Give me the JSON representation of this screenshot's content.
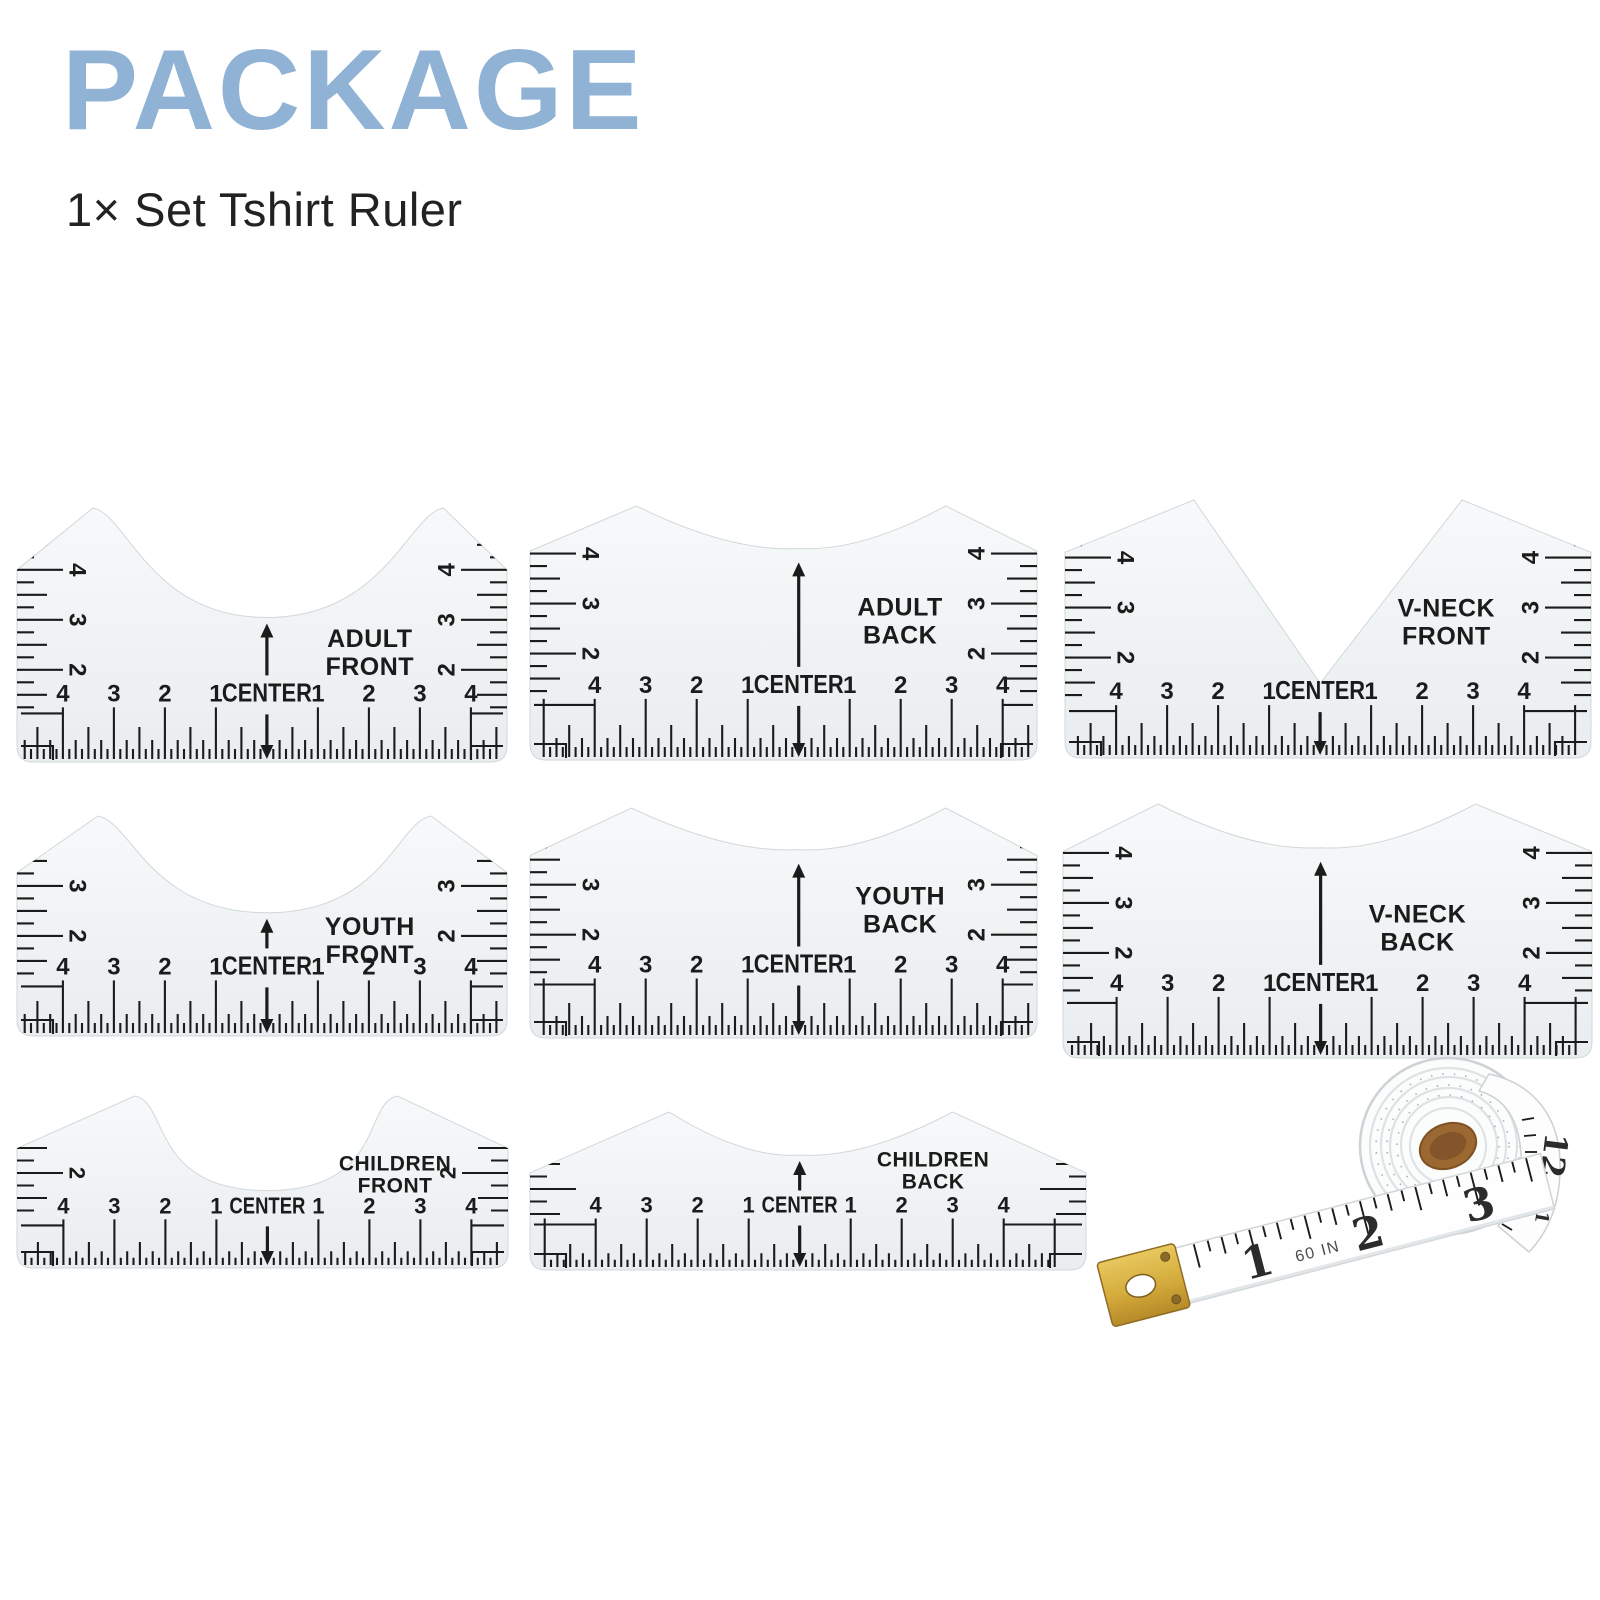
{
  "header": {
    "title": "PACKAGE",
    "subtitle": "1× Set Tshirt Ruler",
    "title_color": "#8fb2d5",
    "subtitle_color": "#222222"
  },
  "colors": {
    "ruler_ink": "#1b1b1b",
    "ruler_body_light": "#f7f9fa",
    "ruler_body_dark": "#e9edef",
    "tape_gold": "#d4ab3c",
    "tape_core_brown": "#9c6832"
  },
  "rulers": [
    {
      "id": "adult-front",
      "label": [
        "ADULT",
        "FRONT"
      ],
      "center_label": "CENTER",
      "side_numbers": [
        "4",
        "3",
        "2"
      ],
      "bottom_numbers": [
        "4",
        "3",
        "2",
        "1",
        "CENTER",
        "1",
        "2",
        "3",
        "4"
      ]
    },
    {
      "id": "adult-back",
      "label": [
        "ADULT",
        "BACK"
      ],
      "center_label": "CENTER",
      "side_numbers": [
        "4",
        "3",
        "2"
      ],
      "bottom_numbers": [
        "4",
        "3",
        "2",
        "1",
        "CENTER",
        "1",
        "2",
        "3",
        "4"
      ]
    },
    {
      "id": "vneck-front",
      "label": [
        "V-NECK",
        "FRONT"
      ],
      "center_label": "CENTER",
      "side_numbers": [
        "4",
        "3",
        "2"
      ],
      "bottom_numbers": [
        "4",
        "3",
        "2",
        "1",
        "CENTER",
        "1",
        "2",
        "3",
        "4"
      ]
    },
    {
      "id": "youth-front",
      "label": [
        "YOUTH",
        "FRONT"
      ],
      "center_label": "CENTER",
      "side_numbers": [
        "3",
        "2"
      ],
      "bottom_numbers": [
        "4",
        "3",
        "2",
        "1",
        "CENTER",
        "1",
        "2",
        "3",
        "4"
      ]
    },
    {
      "id": "youth-back",
      "label": [
        "YOUTH",
        "BACK"
      ],
      "center_label": "CENTER",
      "side_numbers": [
        "3",
        "2"
      ],
      "bottom_numbers": [
        "4",
        "3",
        "2",
        "1",
        "CENTER",
        "1",
        "2",
        "3",
        "4"
      ]
    },
    {
      "id": "vneck-back",
      "label": [
        "V-NECK",
        "BACK"
      ],
      "center_label": "CENTER",
      "side_numbers": [
        "4",
        "3",
        "2"
      ],
      "bottom_numbers": [
        "4",
        "3",
        "2",
        "1",
        "CENTER",
        "1",
        "2",
        "3",
        "4"
      ]
    },
    {
      "id": "children-front",
      "label": [
        "CHILDREN",
        "FRONT"
      ],
      "center_label": "CENTER",
      "side_numbers": [
        "2"
      ],
      "bottom_numbers": [
        "4",
        "3",
        "2",
        "1",
        "CENTER",
        "1",
        "2",
        "3",
        "4"
      ]
    },
    {
      "id": "children-back",
      "label": [
        "CHILDREN",
        "BACK"
      ],
      "center_label": "CENTER",
      "side_numbers": [],
      "bottom_numbers": [
        "4",
        "3",
        "2",
        "1",
        "CENTER",
        "1",
        "2",
        "3",
        "4"
      ]
    }
  ],
  "tape_measure": {
    "numbers": [
      "1",
      "2",
      "3"
    ],
    "unit_label": "60 IN",
    "end_numbers": [
      "12",
      "11"
    ]
  }
}
